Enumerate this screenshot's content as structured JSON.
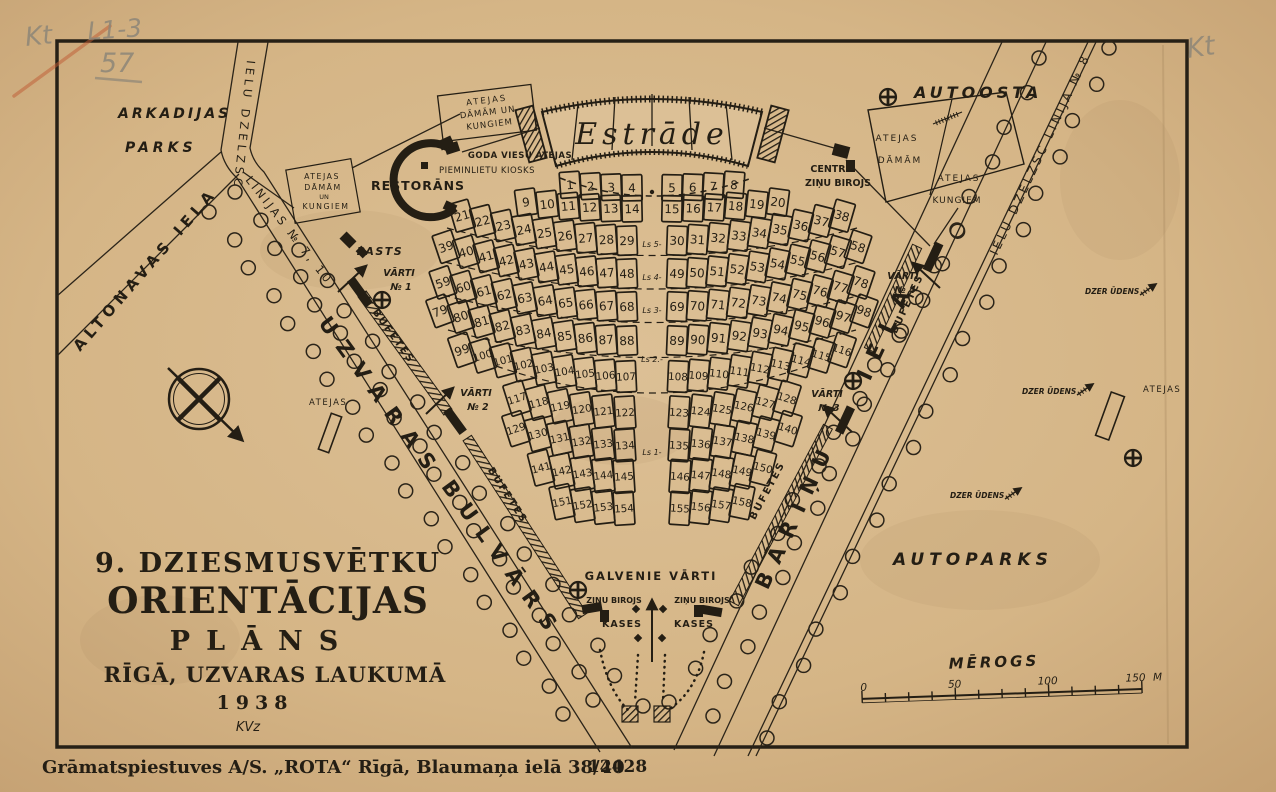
{
  "postcard": {
    "title_lines": [
      "9. DZIESMUSVĒTKU",
      "ORIENTĀCIJAS",
      "PLĀNS",
      "RĪGĀ, UZVARAS LAUKUMĀ",
      "1938"
    ],
    "signature": "KVz",
    "imprint": "Grāmatspiestuves A/S. „ROTA“ Rīgā, Blaumaņa ielā 38/40",
    "imprint_number": "12428",
    "handwriting": {
      "top_left_code": "Kt",
      "catalog": "L1-3",
      "number": "57",
      "top_right": "Kt"
    }
  },
  "areas": {
    "park_line1": "ARKADIJAS",
    "park_line2": "PARKS",
    "autoosta": "AUTOOSTA",
    "autoparks": "AUTOPARKS"
  },
  "streets": {
    "altonavas": "ALTONAVAS IELA",
    "uzvaras_1": "UZVARAS",
    "uzvaras_2": "BULVĀRS",
    "barinu_1": "BĀRIŅU",
    "barinu_2": "IELA",
    "tram_left_1": "IELU DZELZSC",
    "tram_left_2": "LINIJAS № 7, 10",
    "tram_right": "IELU DZELZSC LINIJA № 8"
  },
  "venue": {
    "stage": "Estrāde",
    "restaurant": "RESTORĀNS",
    "post": "PASTS",
    "kiosk": "PIEMINLIETU KIOSKS",
    "vip_toilets": "GODA VIESU ATEJAS",
    "stage_box": [
      "ATEJAS",
      "DĀMĀM UN",
      "KUNGIEM"
    ],
    "left_box": [
      "ATEJAS",
      "DĀMĀM",
      "UN",
      "KUNGIEM"
    ],
    "right_box1": [
      "ATEJAS",
      "DĀMĀM"
    ],
    "right_box2": [
      "ATEJAS",
      "KUNGIEM"
    ],
    "news_center": [
      "CENTR",
      "ZIŅU BIROJS"
    ],
    "news": "ZIŅU BIROJS",
    "kases": "KASES",
    "main_gate": "GALVENIE VĀRTI",
    "gate_word": "VĀRTI",
    "gates": [
      "№ 1",
      "№ 2",
      "№ 3",
      "№ 4"
    ],
    "buffet": "BUFETES",
    "toilets": "ATEJAS",
    "water": "DZER ŪDENS"
  },
  "scale": {
    "label": "MĒROGS",
    "ticks": [
      "0",
      "50",
      "100",
      "150"
    ],
    "unit": "M"
  },
  "blocks": {
    "prices": [
      "Ls 5-",
      "Ls 4-",
      "Ls 3-",
      "Ls 2.-",
      "Ls 1-"
    ],
    "rows": [
      [
        1,
        2,
        3,
        4,
        5,
        6,
        7,
        8
      ],
      [
        9,
        10,
        11,
        12,
        13,
        14,
        15,
        16,
        17,
        18,
        19,
        20
      ],
      [
        21,
        22,
        23,
        24,
        25,
        26,
        27,
        28,
        29,
        30,
        31,
        32,
        33,
        34,
        35,
        36,
        37,
        38
      ],
      [
        39,
        40,
        41,
        42,
        43,
        44,
        45,
        46,
        47,
        48,
        49,
        50,
        51,
        52,
        53,
        54,
        55,
        56,
        57,
        58
      ],
      [
        59,
        60,
        61,
        62,
        63,
        64,
        65,
        66,
        67,
        68,
        69,
        70,
        71,
        72,
        73,
        74,
        75,
        76,
        77,
        78
      ],
      [
        79,
        80,
        81,
        82,
        83,
        84,
        85,
        86,
        87,
        88,
        89,
        90,
        91,
        92,
        93,
        94,
        95,
        96,
        97,
        98
      ],
      [
        99,
        100,
        101,
        102,
        103,
        104,
        105,
        106,
        107,
        108,
        109,
        110,
        111,
        112,
        113,
        114,
        115,
        116
      ],
      [
        117,
        118,
        119,
        120,
        121,
        122,
        123,
        124,
        125,
        126,
        127,
        128
      ],
      [
        129,
        130,
        131,
        132,
        133,
        134,
        135,
        136,
        137,
        138,
        139,
        140
      ],
      [
        141,
        142,
        143,
        144,
        145,
        146,
        147,
        148,
        149,
        150
      ],
      [
        151,
        152,
        153,
        154,
        155,
        156,
        157,
        158
      ]
    ]
  }
}
